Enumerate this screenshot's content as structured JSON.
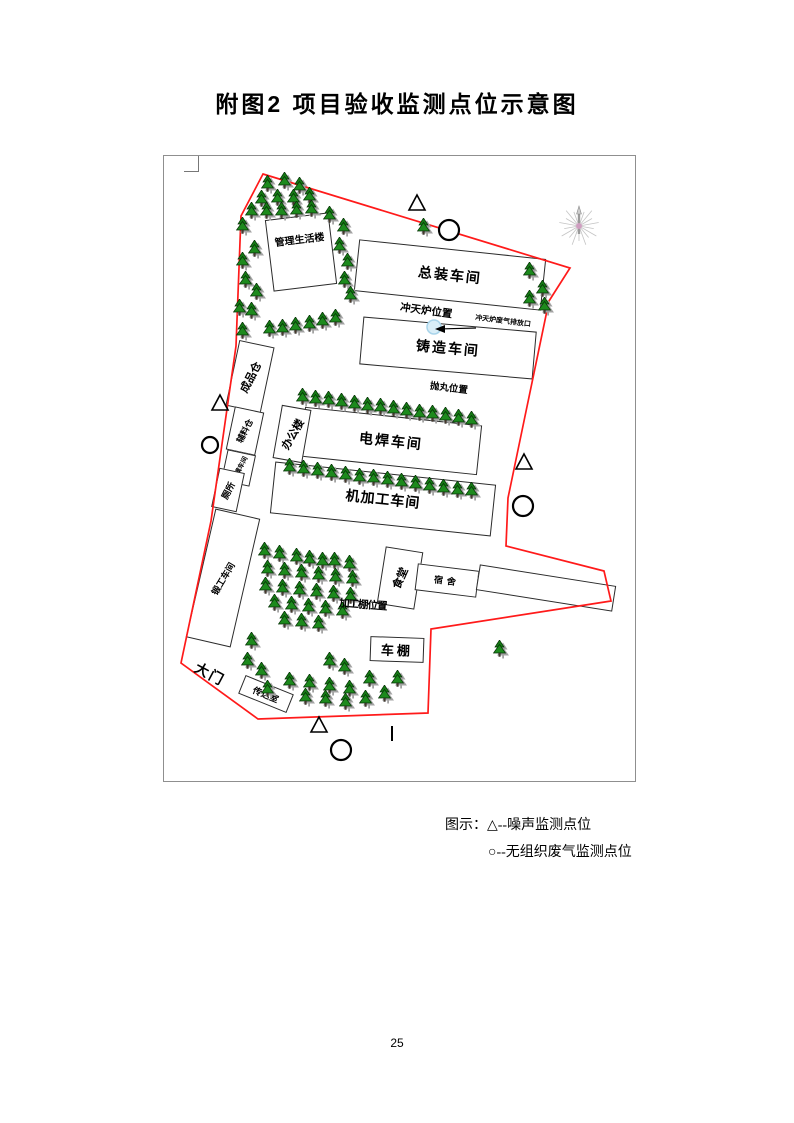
{
  "page": {
    "title": "附图2 项目验收监测点位示意图",
    "page_number": "25"
  },
  "legend": {
    "prefix": "图示：",
    "noise_item": "△--噪声监测点位",
    "gas_item": "○--无组织废气监测点位"
  },
  "map": {
    "boundary_color": "#ff1a1a",
    "boundary_points": "99,18 406,112 385,145 360,265 344,342 342,390 440,415 447,445 267,473 264,557 94,563 17,507 47,365 72,190 77,60",
    "buildings": [
      {
        "id": "management-living-building",
        "label": "管理生活楼"
      },
      {
        "id": "final-assembly-workshop",
        "label": "总装车间"
      },
      {
        "id": "casting-workshop",
        "label": "铸造车间"
      },
      {
        "id": "welding-workshop",
        "label": "电焊车间"
      },
      {
        "id": "machining-workshop",
        "label": "机加工车间"
      },
      {
        "id": "finished-goods-warehouse",
        "label": "成品仓"
      },
      {
        "id": "auxiliary-material-warehouse",
        "label": "辅料仓"
      },
      {
        "id": "wood-pattern-workshop",
        "label": "木模车间"
      },
      {
        "id": "toilet",
        "label": "厕所"
      },
      {
        "id": "office-building",
        "label": "办公楼"
      },
      {
        "id": "forging-workshop",
        "label": "锻工车间"
      },
      {
        "id": "canteen",
        "label": "食堂"
      },
      {
        "id": "dormitory",
        "label": "宿舍"
      },
      {
        "id": "bike-shed",
        "label": "车棚"
      },
      {
        "id": "gatehouse",
        "label": "传达室"
      }
    ],
    "annotations": {
      "gate": {
        "label": "大门"
      },
      "cupola_position": {
        "label": "冲天炉位置"
      },
      "cupola_outlet": {
        "label": "冲天炉废气排放口"
      },
      "shot_blasting": {
        "label": "抛丸位置"
      },
      "processing_shed": {
        "label": "加工棚位置"
      }
    },
    "monitoring_points": {
      "noise": [
        {
          "x": 253,
          "y": 48
        },
        {
          "x": 56,
          "y": 248
        },
        {
          "x": 360,
          "y": 307
        },
        {
          "x": 155,
          "y": 570
        }
      ],
      "gas": [
        {
          "x": 285,
          "y": 74,
          "r": 10
        },
        {
          "x": 46,
          "y": 289,
          "r": 8
        },
        {
          "x": 359,
          "y": 350,
          "r": 10
        },
        {
          "x": 177,
          "y": 594,
          "r": 10
        }
      ]
    },
    "trees": [
      [
        105,
        30
      ],
      [
        122,
        27
      ],
      [
        137,
        32
      ],
      [
        99,
        45
      ],
      [
        115,
        44
      ],
      [
        131,
        44
      ],
      [
        147,
        42
      ],
      [
        89,
        57
      ],
      [
        104,
        57
      ],
      [
        119,
        57
      ],
      [
        134,
        56
      ],
      [
        149,
        55
      ],
      [
        80,
        72
      ],
      [
        167,
        61
      ],
      [
        181,
        73
      ],
      [
        92,
        95
      ],
      [
        80,
        107
      ],
      [
        177,
        92
      ],
      [
        185,
        108
      ],
      [
        83,
        126
      ],
      [
        94,
        138
      ],
      [
        182,
        126
      ],
      [
        188,
        141
      ],
      [
        77,
        154
      ],
      [
        89,
        157
      ],
      [
        107,
        175
      ],
      [
        120,
        174
      ],
      [
        133,
        172
      ],
      [
        147,
        170
      ],
      [
        160,
        167
      ],
      [
        173,
        164
      ],
      [
        80,
        177
      ],
      [
        261,
        73
      ],
      [
        284,
        77
      ],
      [
        367,
        117
      ],
      [
        380,
        135
      ],
      [
        367,
        145
      ],
      [
        382,
        152
      ],
      [
        140,
        243
      ],
      [
        153,
        245
      ],
      [
        166,
        246
      ],
      [
        179,
        248
      ],
      [
        192,
        250
      ],
      [
        205,
        252
      ],
      [
        218,
        253
      ],
      [
        231,
        255
      ],
      [
        244,
        257
      ],
      [
        257,
        259
      ],
      [
        270,
        260
      ],
      [
        283,
        262
      ],
      [
        296,
        264
      ],
      [
        309,
        266
      ],
      [
        127,
        313
      ],
      [
        141,
        315
      ],
      [
        155,
        317
      ],
      [
        169,
        319
      ],
      [
        183,
        321
      ],
      [
        197,
        323
      ],
      [
        211,
        324
      ],
      [
        225,
        326
      ],
      [
        239,
        328
      ],
      [
        253,
        330
      ],
      [
        267,
        332
      ],
      [
        281,
        334
      ],
      [
        295,
        336
      ],
      [
        309,
        337
      ],
      [
        102,
        397
      ],
      [
        117,
        400
      ],
      [
        134,
        403
      ],
      [
        147,
        405
      ],
      [
        160,
        407
      ],
      [
        172,
        407
      ],
      [
        187,
        410
      ],
      [
        105,
        415
      ],
      [
        122,
        417
      ],
      [
        139,
        419
      ],
      [
        156,
        421
      ],
      [
        173,
        423
      ],
      [
        190,
        425
      ],
      [
        103,
        432
      ],
      [
        120,
        434
      ],
      [
        137,
        436
      ],
      [
        154,
        438
      ],
      [
        171,
        440
      ],
      [
        188,
        442
      ],
      [
        112,
        449
      ],
      [
        129,
        451
      ],
      [
        146,
        453
      ],
      [
        163,
        455
      ],
      [
        180,
        457
      ],
      [
        122,
        466
      ],
      [
        139,
        468
      ],
      [
        156,
        470
      ],
      [
        89,
        487
      ],
      [
        85,
        507
      ],
      [
        99,
        517
      ],
      [
        167,
        507
      ],
      [
        182,
        513
      ],
      [
        105,
        535
      ],
      [
        127,
        527
      ],
      [
        147,
        529
      ],
      [
        167,
        532
      ],
      [
        187,
        535
      ],
      [
        207,
        525
      ],
      [
        143,
        543
      ],
      [
        163,
        545
      ],
      [
        183,
        548
      ],
      [
        203,
        545
      ],
      [
        222,
        540
      ],
      [
        235,
        525
      ],
      [
        337,
        495
      ]
    ]
  }
}
